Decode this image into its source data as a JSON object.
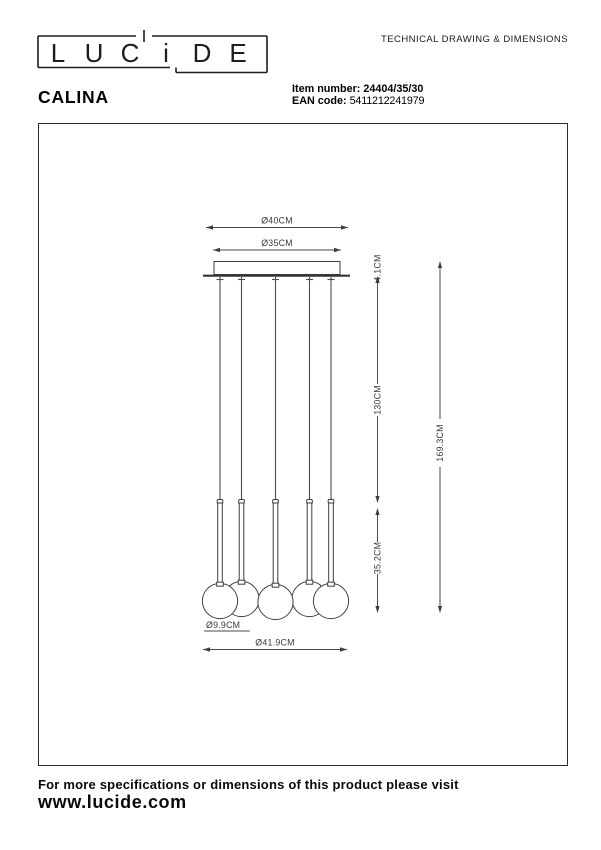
{
  "brand": {
    "logo_letters": [
      "L",
      "U",
      "C",
      "i",
      "D",
      "E"
    ]
  },
  "header": {
    "doc_title": "TECHNICAL DRAWING & DIMENSIONS",
    "product_name": "CALINA",
    "item_number_label": "Item number:",
    "item_number_value": "24404/35/30",
    "ean_label": "EAN code:",
    "ean_value": "5411212241979"
  },
  "drawing": {
    "dim_canopy_width_outer": "Ø40CM",
    "dim_canopy_width_inner": "Ø35CM",
    "dim_canopy_height": "4.1CM",
    "dim_cord_length": "130CM",
    "dim_pendant_height": "35.2CM",
    "dim_total_height": "169.3CM",
    "dim_globe_diameter": "Ø9.9CM",
    "dim_overall_width": "Ø41.9CM"
  },
  "footer": {
    "note": "For more specifications or dimensions of this product please visit",
    "website": "www.lucide.com"
  },
  "colors": {
    "ink": "#000000",
    "drawing_line": "#3f3f3f",
    "frame_border": "#2b2b2b"
  }
}
